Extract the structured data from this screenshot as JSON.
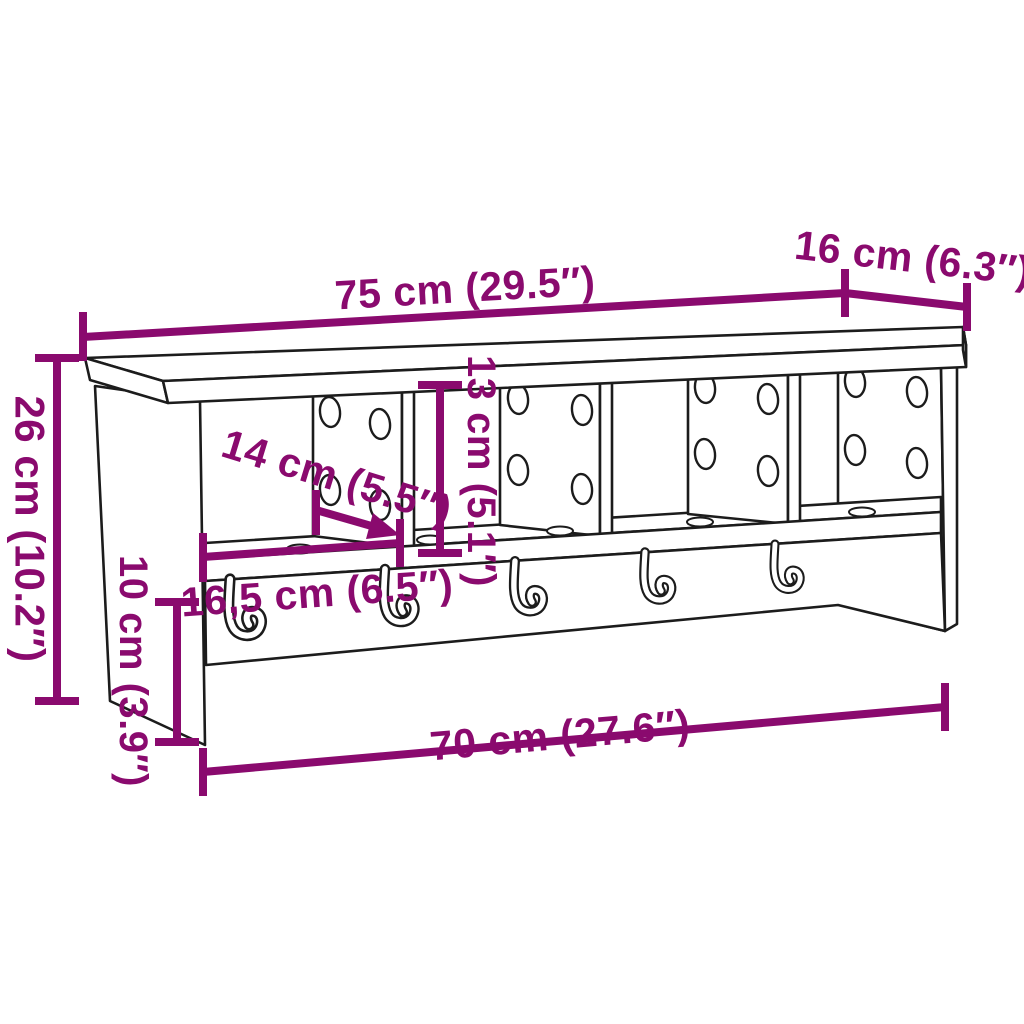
{
  "diagram": {
    "subject": "wall-mounted-coat-rack-with-shelf",
    "dimensions": {
      "total_width": "75 cm (29.5″)",
      "depth": "16 cm (6.3″)",
      "total_height": "26 cm (10.2″)",
      "compartment_height": "13 cm (5.1″)",
      "compartment_depth": "14 cm (5.5″)",
      "compartment_width": "16,5 cm (6.5″)",
      "rail_height": "10 cm (3.9″)",
      "inner_width": "70 cm (27.6″)"
    },
    "colors": {
      "dimension": "#8a0a6e",
      "outline": "#1c1c1c",
      "background": "#ffffff"
    }
  }
}
